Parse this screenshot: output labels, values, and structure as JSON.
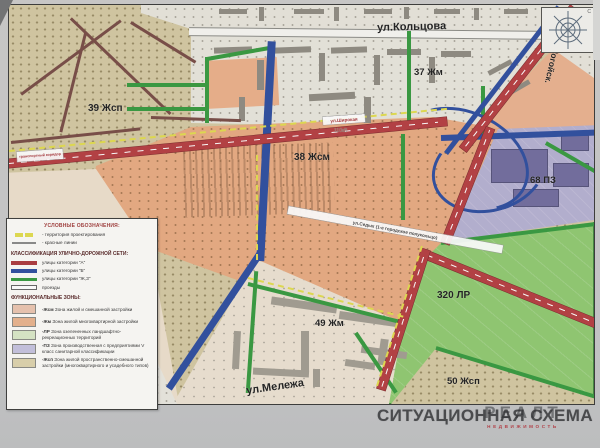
{
  "title": "СИТУАЦИОННАЯ СХЕМА",
  "watermark": {
    "brand": "РЕАЛТ",
    "tagline": "НЕДВИЖИМОСТЬ"
  },
  "compass": {
    "north": "С"
  },
  "map_labels": {
    "zones": [
      {
        "label": "39 Жсп"
      },
      {
        "label": "37 Жм"
      },
      {
        "label": "38 Жсм"
      },
      {
        "label": "68 ПЗ"
      },
      {
        "label": "320 ЛР"
      },
      {
        "label": "49 Жм"
      },
      {
        "label": "50 Жсп"
      }
    ],
    "streets": {
      "kolcova": "ул.Кольцова",
      "logoisky": "Логойск.",
      "melezha": "ул.Мележа",
      "shirokaya": "ул.Широкая",
      "sedykh": "ул.Седых (1-е городское полукольцо)",
      "corridor": "транспортный коридор",
      "powerline": "110кВ"
    }
  },
  "legend": {
    "symbols_header": "УСЛОВНЫЕ ОБОЗНАЧЕНИЯ:",
    "symbols": [
      {
        "label": "- территория проектирования",
        "swatch_color": "#e3dd3f"
      },
      {
        "label": "- красные линии",
        "swatch_color": "#8a8a88"
      }
    ],
    "roads_header": "КЛАССИФИКАЦИЯ УЛИЧНО-ДОРОЖНОЙ СЕТИ:",
    "road_classes": [
      {
        "label": "улицы категории \"А\"",
        "color": "#b5373c"
      },
      {
        "label": "улицы категории \"Б\"",
        "color": "#2b4ea8"
      },
      {
        "label": "улицы категории \"Ж,З\"",
        "color": "#2f9c38"
      },
      {
        "label": "проезды",
        "color": "#ffffff"
      }
    ],
    "zones_header": "ФУНКЦИОНАЛЬНЫЕ ЗОНЫ:",
    "zone_classes": [
      {
        "code": "-Жсм",
        "label": "Зона жилой и смешанной застройки",
        "color": "#eec4ac"
      },
      {
        "code": "-Жм",
        "label": "Зона жилой многоквартирной застройки",
        "color": "#edb288"
      },
      {
        "code": "-ЛР",
        "label": "Зона озелененных ландшафтно-рекреационных территорий",
        "color": "#d8e8c4"
      },
      {
        "code": "-ПЗ",
        "label": "Зона производственная с предприятиями V класс санитарной классификации",
        "color": "#c6c2e2"
      },
      {
        "code": "-Жсп",
        "label": "Зона жилой пространственно-смешанной застройки (многоквартирного и усадебного типов)",
        "color": "#ded2a8"
      }
    ]
  }
}
